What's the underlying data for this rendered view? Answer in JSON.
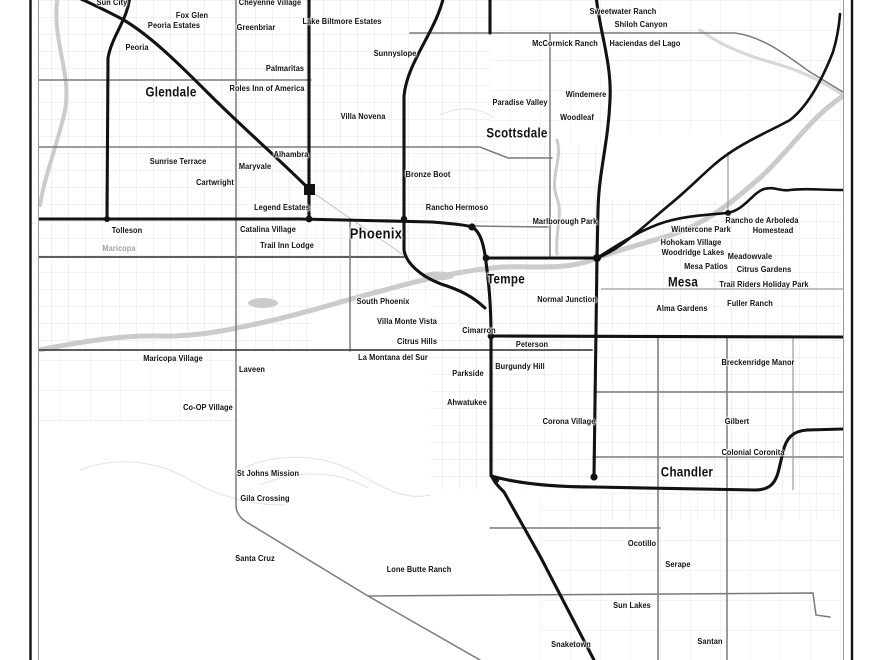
{
  "map": {
    "description": "Minimalist black-and-white street map poster of the Phoenix metropolitan area",
    "labels": [
      {
        "text": "Sun City",
        "x": 112,
        "y": 2,
        "type": "place"
      },
      {
        "text": "Cheyenne Village",
        "x": 270,
        "y": 2,
        "type": "place"
      },
      {
        "text": "Sweetwater Ranch",
        "x": 623,
        "y": 11,
        "type": "place"
      },
      {
        "text": "Fox Glen",
        "x": 192,
        "y": 15,
        "type": "place"
      },
      {
        "text": "Lake Biltmore Estates",
        "x": 342,
        "y": 21,
        "type": "place"
      },
      {
        "text": "Shiloh Canyon",
        "x": 641,
        "y": 24,
        "type": "place"
      },
      {
        "text": "Peoria Estates",
        "x": 174,
        "y": 25,
        "type": "place"
      },
      {
        "text": "Greenbriar",
        "x": 256,
        "y": 27,
        "type": "place"
      },
      {
        "text": "McCormick Ranch",
        "x": 565,
        "y": 43,
        "type": "place"
      },
      {
        "text": "Haciendas del Lago",
        "x": 645,
        "y": 43,
        "type": "place"
      },
      {
        "text": "Peoria",
        "x": 137,
        "y": 47,
        "type": "place"
      },
      {
        "text": "Sunnyslope",
        "x": 395,
        "y": 53,
        "type": "place"
      },
      {
        "text": "Palmaritas",
        "x": 285,
        "y": 68,
        "type": "place"
      },
      {
        "text": "Roles Inn of America",
        "x": 267,
        "y": 88,
        "type": "place"
      },
      {
        "text": "Glendale",
        "x": 171,
        "y": 92,
        "type": "city"
      },
      {
        "text": "Windemere",
        "x": 586,
        "y": 94,
        "type": "place"
      },
      {
        "text": "Paradise Valley",
        "x": 520,
        "y": 102,
        "type": "place"
      },
      {
        "text": "Villa Novena",
        "x": 363,
        "y": 116,
        "type": "place"
      },
      {
        "text": "Woodleaf",
        "x": 577,
        "y": 117,
        "type": "place"
      },
      {
        "text": "Scottsdale",
        "x": 517,
        "y": 133,
        "type": "city"
      },
      {
        "text": "Alhambra",
        "x": 291,
        "y": 154,
        "type": "place"
      },
      {
        "text": "Sunrise Terrace",
        "x": 178,
        "y": 161,
        "type": "place"
      },
      {
        "text": "Maryvale",
        "x": 255,
        "y": 166,
        "type": "place"
      },
      {
        "text": "Bronze Boot",
        "x": 428,
        "y": 174,
        "type": "place"
      },
      {
        "text": "Cartwright",
        "x": 215,
        "y": 182,
        "type": "place"
      },
      {
        "text": "Legend Estates",
        "x": 282,
        "y": 207,
        "type": "place"
      },
      {
        "text": "Rancho Hermoso",
        "x": 457,
        "y": 207,
        "type": "place"
      },
      {
        "text": "Marlborough Park",
        "x": 565,
        "y": 221,
        "type": "place"
      },
      {
        "text": "Rancho de Arboleda",
        "x": 762,
        "y": 220,
        "type": "place"
      },
      {
        "text": "Wintercone Park",
        "x": 701,
        "y": 229,
        "type": "place"
      },
      {
        "text": "Homestead",
        "x": 773,
        "y": 230,
        "type": "place"
      },
      {
        "text": "Tolleson",
        "x": 127,
        "y": 230,
        "type": "place"
      },
      {
        "text": "Catalina Village",
        "x": 268,
        "y": 229,
        "type": "place"
      },
      {
        "text": "Phoenix",
        "x": 376,
        "y": 234,
        "type": "city-major"
      },
      {
        "text": "Hohokam Village",
        "x": 691,
        "y": 242,
        "type": "place"
      },
      {
        "text": "Trail Inn Lodge",
        "x": 287,
        "y": 245,
        "type": "place"
      },
      {
        "text": "Maricopa",
        "x": 119,
        "y": 248,
        "type": "county"
      },
      {
        "text": "Woodridge Lakes",
        "x": 693,
        "y": 252,
        "type": "place"
      },
      {
        "text": "Meadowvale",
        "x": 750,
        "y": 256,
        "type": "place"
      },
      {
        "text": "Mesa Patios",
        "x": 706,
        "y": 266,
        "type": "place"
      },
      {
        "text": "Citrus Gardens",
        "x": 764,
        "y": 269,
        "type": "place"
      },
      {
        "text": "Tempe",
        "x": 506,
        "y": 279,
        "type": "city"
      },
      {
        "text": "Mesa",
        "x": 683,
        "y": 282,
        "type": "city"
      },
      {
        "text": "Trail Riders Holiday Park",
        "x": 764,
        "y": 284,
        "type": "place"
      },
      {
        "text": "Normal Junction",
        "x": 567,
        "y": 299,
        "type": "place"
      },
      {
        "text": "South Phoenix",
        "x": 383,
        "y": 301,
        "type": "place"
      },
      {
        "text": "Fuller Ranch",
        "x": 750,
        "y": 303,
        "type": "place"
      },
      {
        "text": "Alma Gardens",
        "x": 682,
        "y": 308,
        "type": "place"
      },
      {
        "text": "Villa Monte Vista",
        "x": 407,
        "y": 321,
        "type": "place"
      },
      {
        "text": "Cimarron",
        "x": 479,
        "y": 330,
        "type": "place"
      },
      {
        "text": "Citrus Hills",
        "x": 417,
        "y": 341,
        "type": "place"
      },
      {
        "text": "Peterson",
        "x": 532,
        "y": 344,
        "type": "place"
      },
      {
        "text": "Maricopa Village",
        "x": 173,
        "y": 358,
        "type": "place"
      },
      {
        "text": "La Montana del Sur",
        "x": 393,
        "y": 357,
        "type": "place"
      },
      {
        "text": "Breckenridge Manor",
        "x": 758,
        "y": 362,
        "type": "place"
      },
      {
        "text": "Burgundy Hill",
        "x": 520,
        "y": 366,
        "type": "place"
      },
      {
        "text": "Laveen",
        "x": 252,
        "y": 369,
        "type": "place"
      },
      {
        "text": "Parkside",
        "x": 468,
        "y": 373,
        "type": "place"
      },
      {
        "text": "Ahwatukee",
        "x": 467,
        "y": 402,
        "type": "place"
      },
      {
        "text": "Co-OP Village",
        "x": 208,
        "y": 407,
        "type": "place"
      },
      {
        "text": "Corona Village",
        "x": 569,
        "y": 421,
        "type": "place"
      },
      {
        "text": "Gilbert",
        "x": 737,
        "y": 421,
        "type": "place"
      },
      {
        "text": "Colonial Coronita",
        "x": 753,
        "y": 452,
        "type": "place"
      },
      {
        "text": "Chandler",
        "x": 687,
        "y": 472,
        "type": "city"
      },
      {
        "text": "St Johns Mission",
        "x": 268,
        "y": 473,
        "type": "place"
      },
      {
        "text": "Gila Crossing",
        "x": 265,
        "y": 498,
        "type": "place"
      },
      {
        "text": "Ocotillo",
        "x": 642,
        "y": 543,
        "type": "place"
      },
      {
        "text": "Santa Cruz",
        "x": 255,
        "y": 558,
        "type": "place"
      },
      {
        "text": "Serape",
        "x": 678,
        "y": 564,
        "type": "place"
      },
      {
        "text": "Lone Butte Ranch",
        "x": 419,
        "y": 569,
        "type": "place"
      },
      {
        "text": "Sun Lakes",
        "x": 632,
        "y": 605,
        "type": "place"
      },
      {
        "text": "Santan",
        "x": 710,
        "y": 641,
        "type": "place"
      },
      {
        "text": "Snaketown",
        "x": 571,
        "y": 644,
        "type": "place"
      }
    ]
  },
  "colors": {
    "background": "#ffffff",
    "freeway": "#121212",
    "major_road": "#7a7a7a",
    "major_road_dark": "#474747",
    "minor_grid": "#dcdcdc",
    "water": "#cbcbcb",
    "label": "#111111",
    "label_muted": "#a0a0a0",
    "frame": "#111111"
  }
}
